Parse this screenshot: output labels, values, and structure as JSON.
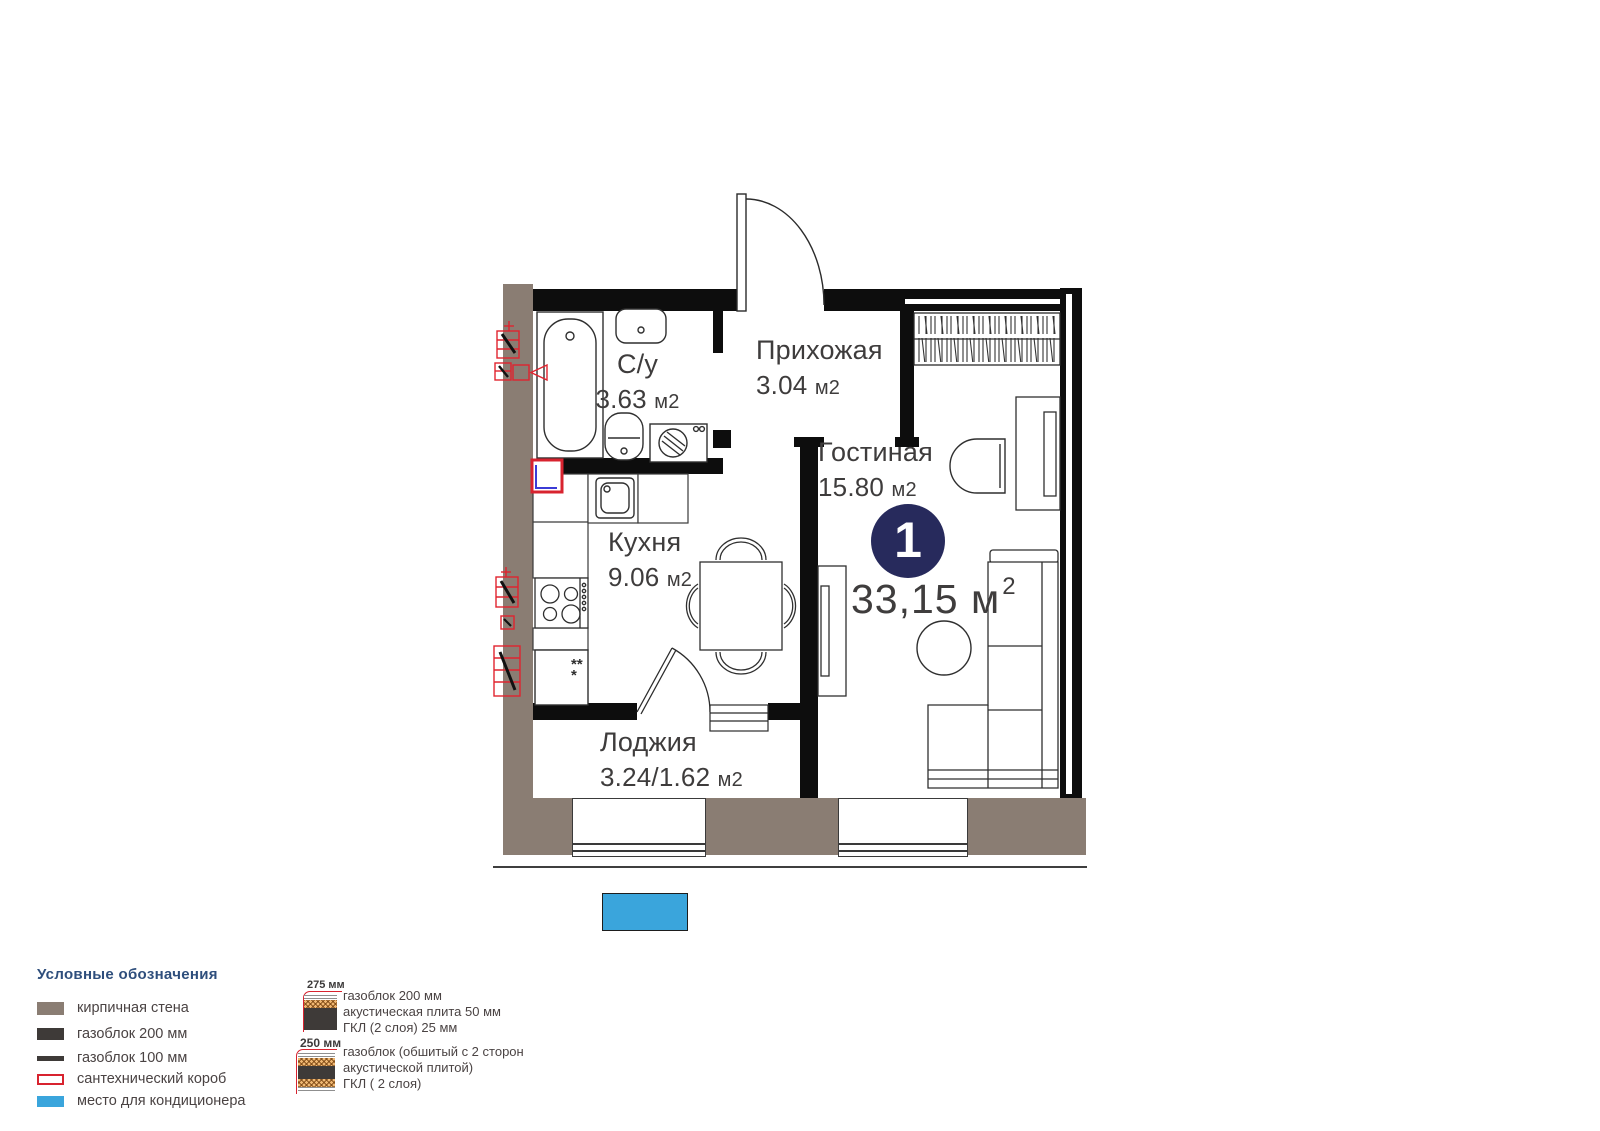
{
  "plan": {
    "rooms": {
      "bathroom": {
        "name": "С/у",
        "area": "3.63",
        "unit": "м2"
      },
      "hallway": {
        "name": "Прихожая",
        "area": "3.04",
        "unit": "м2"
      },
      "living": {
        "name": "Гостиная",
        "area": "15.80",
        "unit": "м2"
      },
      "kitchen": {
        "name": "Кухня",
        "area": "9.06",
        "unit": "м2"
      },
      "loggia": {
        "name": "Лоджия",
        "area": "3.24/1.62",
        "unit": "м2"
      }
    },
    "rooms_badge": "1",
    "total_area": {
      "value": "33,15",
      "unit": "м",
      "power": "2"
    },
    "fridge_mark": "***"
  },
  "legend": {
    "title": "Условные обозначения",
    "items": [
      {
        "id": "brick-wall",
        "label": "кирпичная стена",
        "color": "#8a7d73"
      },
      {
        "id": "gasblock-200",
        "label": "газоблок 200 мм",
        "color": "#3e3a38"
      },
      {
        "id": "gasblock-100",
        "label": "газоблок 100 мм",
        "color": "#3e3a38"
      },
      {
        "id": "plumbing-box",
        "label": "сантехнический короб",
        "color": "#d8232f"
      },
      {
        "id": "ac-place",
        "label": "место для кондиционера",
        "color": "#3aa5dc"
      }
    ],
    "wall_sections": [
      {
        "thickness": "275 мм",
        "lines": [
          "газоблок 200 мм",
          "акустическая плита 50 мм",
          "ГКЛ (2 слоя) 25 мм"
        ]
      },
      {
        "thickness": "250 мм",
        "lines": [
          "газоблок (обшитый с 2 сторон",
          "акустической плитой)",
          "ГКЛ ( 2 слоя)"
        ]
      }
    ]
  },
  "colors": {
    "brick": "#8a7d73",
    "wall_black": "#0d0d0d",
    "accent_red": "#d8232f",
    "accent_blue": "#3aa5dc",
    "badge_navy": "#272a5c",
    "legend_title_blue": "#2e4e7c"
  }
}
